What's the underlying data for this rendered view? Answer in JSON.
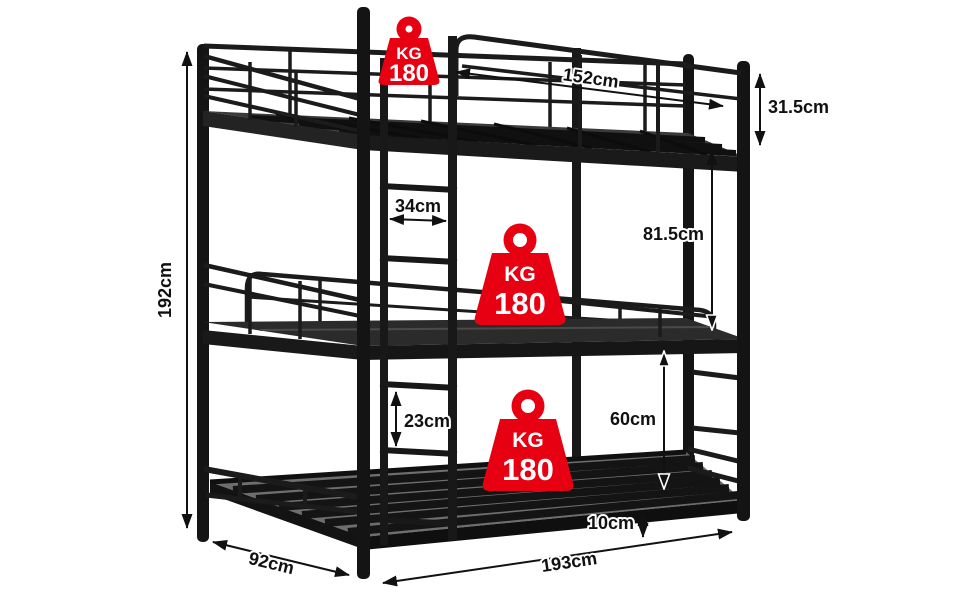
{
  "diagram_title": "Metal triple bunk bed dimension diagram",
  "colors": {
    "accent_red": "#e60012",
    "frame_black": "#181818",
    "dimension_ink": "#111111",
    "badge_text": "#ffffff",
    "background": "#ffffff"
  },
  "badges": [
    {
      "position": "top-bunk",
      "unit": "KG",
      "value": "180"
    },
    {
      "position": "middle-bunk",
      "unit": "KG",
      "value": "180"
    },
    {
      "position": "bottom-bunk",
      "unit": "KG",
      "value": "180"
    }
  ],
  "dims": {
    "height": "192cm",
    "top_length": "152cm",
    "guardrail": "31.5cm",
    "top_mid_clearance": "81.5cm",
    "ladder_width": "34cm",
    "rung_spacing": "23cm",
    "mid_bottom_clearance": "60cm",
    "bottom_height": "10cm",
    "depth": "92cm",
    "length": "193cm"
  }
}
